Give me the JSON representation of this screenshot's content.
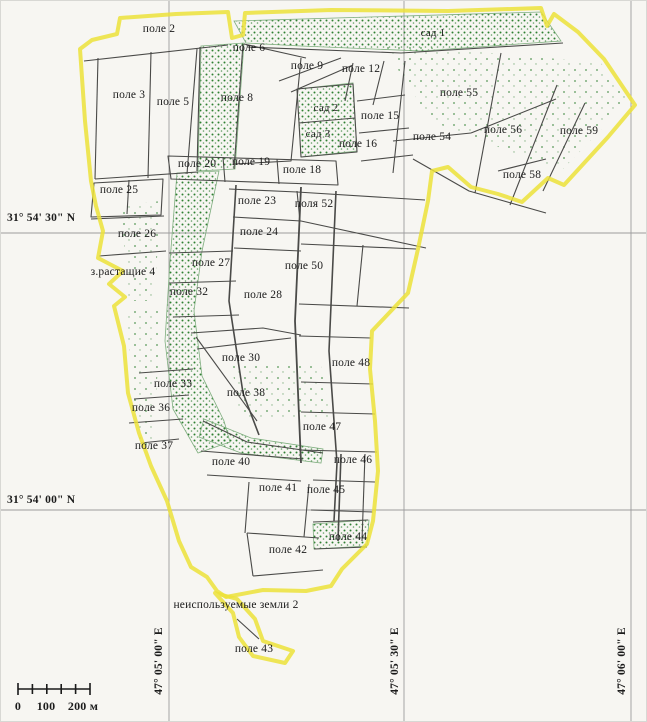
{
  "map": {
    "description": "Cadastral field map with yellow farm boundary, parcel outlines, vegetation overgrowth speckles, coordinate graticule and scale bar",
    "colors": {
      "background": "#f7f6f2",
      "boundary": "#ece23a",
      "parcel_line": "#4a4a48",
      "vegetation": "#2f8032",
      "vegetation_edge": "#7fae7f",
      "grid": "#9c9c9c",
      "text": "#1b1b1b",
      "scale": "#1a1a1a"
    },
    "labels": [
      {
        "text": "поле 2",
        "x": 158,
        "y": 28,
        "kind": "field"
      },
      {
        "text": "поле 6",
        "x": 248,
        "y": 47,
        "kind": "field"
      },
      {
        "text": "поле 9",
        "x": 306,
        "y": 65,
        "kind": "field"
      },
      {
        "text": "поле 12",
        "x": 360,
        "y": 68,
        "kind": "field"
      },
      {
        "text": "сад 1",
        "x": 432,
        "y": 32,
        "kind": "orchard"
      },
      {
        "text": "поле 3",
        "x": 128,
        "y": 94,
        "kind": "field"
      },
      {
        "text": "поле 5",
        "x": 172,
        "y": 101,
        "kind": "field"
      },
      {
        "text": "поле 8",
        "x": 236,
        "y": 97,
        "kind": "field"
      },
      {
        "text": "сад 2",
        "x": 325,
        "y": 107,
        "kind": "orchard"
      },
      {
        "text": "сад 3",
        "x": 317,
        "y": 133,
        "kind": "orchard"
      },
      {
        "text": "поле 15",
        "x": 379,
        "y": 115,
        "kind": "field"
      },
      {
        "text": "поле 16",
        "x": 357,
        "y": 143,
        "kind": "field"
      },
      {
        "text": "поле 55",
        "x": 458,
        "y": 92,
        "kind": "field"
      },
      {
        "text": "поле 54",
        "x": 431,
        "y": 136,
        "kind": "field"
      },
      {
        "text": "поле 56",
        "x": 502,
        "y": 129,
        "kind": "field"
      },
      {
        "text": "поле 59",
        "x": 578,
        "y": 130,
        "kind": "field"
      },
      {
        "text": "поле 58",
        "x": 521,
        "y": 174,
        "kind": "field"
      },
      {
        "text": "поле 20",
        "x": 196,
        "y": 163,
        "kind": "field"
      },
      {
        "text": "поле 19",
        "x": 250,
        "y": 161,
        "kind": "field"
      },
      {
        "text": "поле 18",
        "x": 301,
        "y": 169,
        "kind": "field"
      },
      {
        "text": "поле 25",
        "x": 118,
        "y": 189,
        "kind": "field"
      },
      {
        "text": "поле 23",
        "x": 256,
        "y": 200,
        "kind": "field"
      },
      {
        "text": "поля 52",
        "x": 313,
        "y": 203,
        "kind": "field"
      },
      {
        "text": "поле 26",
        "x": 136,
        "y": 233,
        "kind": "field"
      },
      {
        "text": "поле 24",
        "x": 258,
        "y": 231,
        "kind": "field"
      },
      {
        "text": "поле 27",
        "x": 210,
        "y": 262,
        "kind": "field"
      },
      {
        "text": "поле 50",
        "x": 303,
        "y": 265,
        "kind": "field"
      },
      {
        "text": "з.растащие 4",
        "x": 122,
        "y": 271,
        "kind": "note"
      },
      {
        "text": "поле 32",
        "x": 188,
        "y": 291,
        "kind": "field"
      },
      {
        "text": "поле 28",
        "x": 262,
        "y": 294,
        "kind": "field"
      },
      {
        "text": "поле 30",
        "x": 240,
        "y": 357,
        "kind": "field"
      },
      {
        "text": "поле 48",
        "x": 350,
        "y": 362,
        "kind": "field"
      },
      {
        "text": "поле 33",
        "x": 172,
        "y": 383,
        "kind": "field"
      },
      {
        "text": "поле 38",
        "x": 245,
        "y": 392,
        "kind": "field"
      },
      {
        "text": "поле 36",
        "x": 150,
        "y": 407,
        "kind": "field"
      },
      {
        "text": "поле 47",
        "x": 321,
        "y": 426,
        "kind": "field"
      },
      {
        "text": "поле 37",
        "x": 153,
        "y": 445,
        "kind": "field"
      },
      {
        "text": "поле 40",
        "x": 230,
        "y": 461,
        "kind": "field"
      },
      {
        "text": "поле 46",
        "x": 352,
        "y": 459,
        "kind": "field"
      },
      {
        "text": "поле 41",
        "x": 277,
        "y": 487,
        "kind": "field"
      },
      {
        "text": "поле 45",
        "x": 325,
        "y": 489,
        "kind": "field"
      },
      {
        "text": "поле 44",
        "x": 347,
        "y": 536,
        "kind": "field"
      },
      {
        "text": "поле 42",
        "x": 287,
        "y": 549,
        "kind": "field"
      },
      {
        "text": "неиспользуемые земли 2",
        "x": 235,
        "y": 604,
        "kind": "note"
      },
      {
        "text": "поле 43",
        "x": 253,
        "y": 648,
        "kind": "field"
      },
      {
        "text": "31° 54' 30\" N",
        "x": 6,
        "y": 217,
        "kind": "lat"
      },
      {
        "text": "31° 54' 00\" N",
        "x": 6,
        "y": 499,
        "kind": "lat"
      },
      {
        "text": "47° 05' 00\" E",
        "x": 158,
        "y": 660,
        "kind": "lon"
      },
      {
        "text": "47° 05' 30\" E",
        "x": 394,
        "y": 660,
        "kind": "lon"
      },
      {
        "text": "47° 06' 00\" E",
        "x": 621,
        "y": 660,
        "kind": "lon"
      },
      {
        "text": "0",
        "x": 17,
        "y": 698,
        "kind": "scale"
      },
      {
        "text": "100",
        "x": 45,
        "y": 698,
        "kind": "scale"
      },
      {
        "text": "200 м",
        "x": 82,
        "y": 698,
        "kind": "scale"
      }
    ]
  }
}
